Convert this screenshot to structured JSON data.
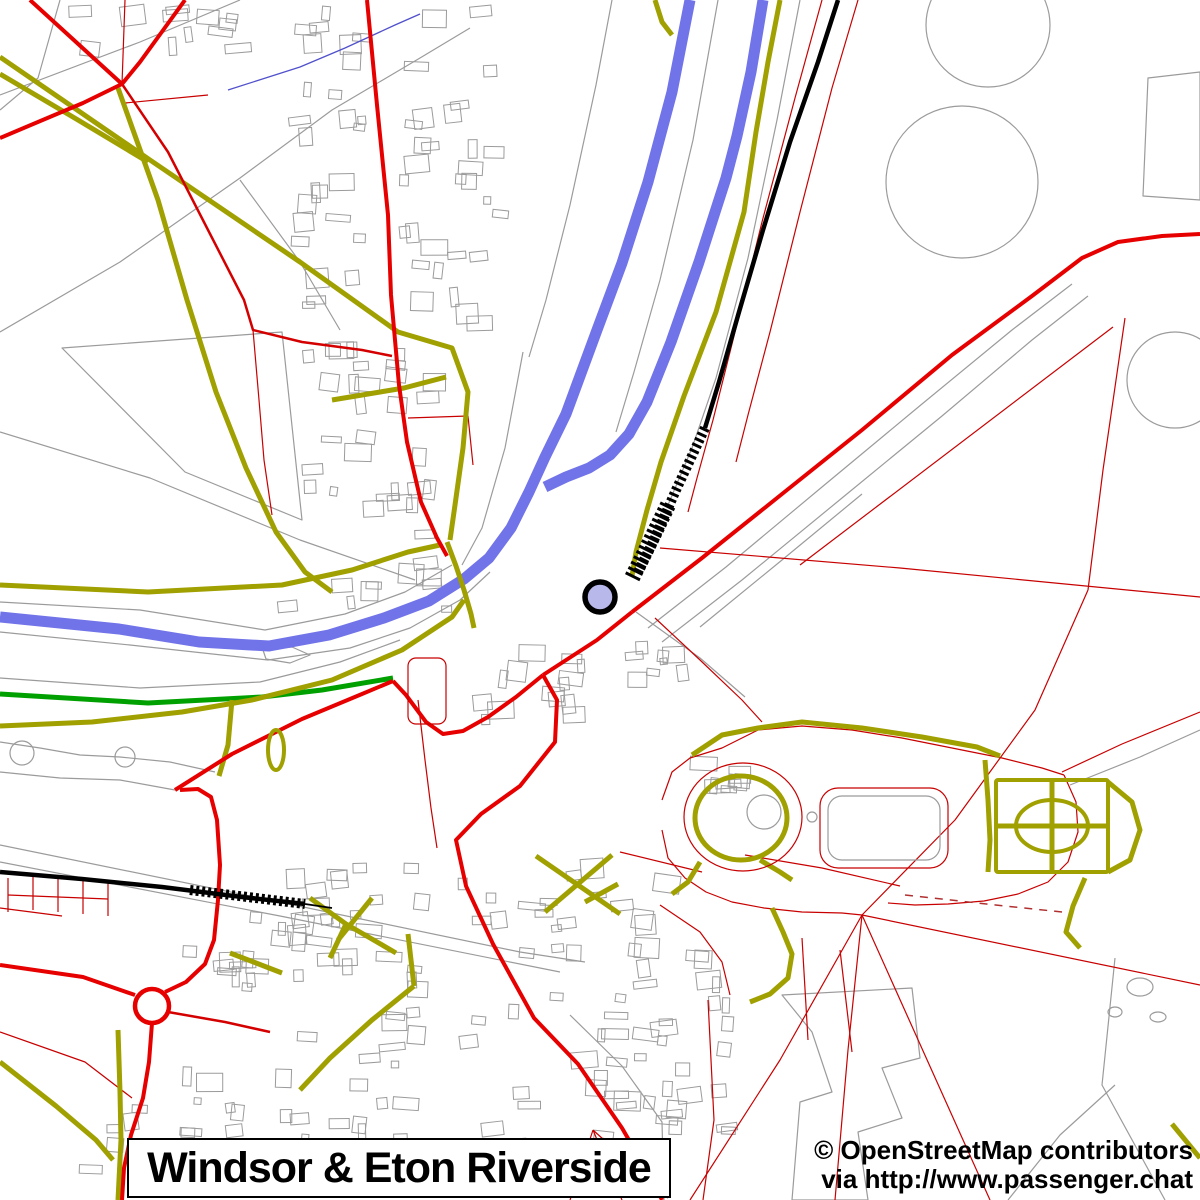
{
  "title_box": {
    "label": "Windsor & Eton Riverside"
  },
  "attribution": {
    "line1": "© OpenStreetMap contributors",
    "line2": "via http://www.passenger.chat"
  },
  "map": {
    "width": 1200,
    "height": 1200,
    "background": "#ffffff",
    "colors": {
      "river": "#7173e8",
      "stream": "#5050cc",
      "road_major": "#e60000",
      "road_mid": "#d40000",
      "road_minor": "#c80000",
      "footpath": "#a0a000",
      "green_route": "#00a000",
      "railway": "#000000",
      "boundary": "#9b9b9b",
      "marker_fill": "#b8b9ea"
    },
    "building_clusters": [
      {
        "x": 288,
        "y": 6,
        "w": 86,
        "h": 330,
        "count": 26,
        "seed": 7
      },
      {
        "x": 398,
        "y": 6,
        "w": 112,
        "h": 330,
        "count": 30,
        "seed": 13
      },
      {
        "x": 300,
        "y": 342,
        "w": 152,
        "h": 212,
        "count": 30,
        "seed": 21
      },
      {
        "x": 262,
        "y": 556,
        "w": 200,
        "h": 60,
        "count": 10,
        "seed": 29
      },
      {
        "x": 60,
        "y": 2,
        "w": 200,
        "h": 55,
        "count": 12,
        "seed": 31
      },
      {
        "x": 255,
        "y": 855,
        "w": 195,
        "h": 290,
        "count": 40,
        "seed": 37
      },
      {
        "x": 452,
        "y": 858,
        "w": 230,
        "h": 320,
        "count": 46,
        "seed": 41
      },
      {
        "x": 600,
        "y": 935,
        "w": 150,
        "h": 200,
        "count": 24,
        "seed": 43
      },
      {
        "x": 180,
        "y": 908,
        "w": 205,
        "h": 85,
        "count": 18,
        "seed": 47
      },
      {
        "x": 470,
        "y": 640,
        "w": 130,
        "h": 90,
        "count": 14,
        "seed": 53
      },
      {
        "x": 620,
        "y": 620,
        "w": 90,
        "h": 70,
        "count": 8,
        "seed": 59
      },
      {
        "x": 690,
        "y": 745,
        "w": 80,
        "h": 60,
        "count": 8,
        "seed": 67
      },
      {
        "x": 60,
        "y": 1060,
        "w": 200,
        "h": 130,
        "count": 16,
        "seed": 71
      }
    ],
    "layers": [
      {
        "name": "boundary-line",
        "stroke": "#9b9b9b",
        "width": 1.2,
        "paths": [
          "M0,95 L140,42 L240,0",
          "M60,0 L38,78 L0,110",
          "M0,332 L120,262 L240,178 L332,110 L420,58 L470,28",
          "M0,432 L150,478 L300,540 L415,580",
          "M62,348 L282,332 L302,520 L185,472 Z",
          "M240,180 L300,262 L340,330",
          "M523,352 L505,448 L482,528 L462,565",
          "M612,0 L596,85 L570,205 L546,300 L529,357",
          "M718,0 L693,140 L660,280 L634,372 L616,432",
          "M800,0 L777,120 L748,258 L716,378 L692,448 L668,505",
          "M648,628 L726,567 L822,487 L922,404 L1012,330 L1072,284",
          "M662,642 L742,580 L842,498 L942,416 L1032,340 L1088,296",
          "M700,627 L782,560 L862,494",
          "M0,602 L140,610 L265,630 L345,614 L405,592 L452,565",
          "M0,632 L130,645 L268,660 L350,648 L410,628 L460,600 L490,572",
          "M263,650 L292,647 L310,655 L290,663 L266,659 Z",
          "M0,845 L260,898 L520,952 L585,962",
          "M0,862 L280,916 L560,972",
          "M782,995 L912,988 L920,1058 L882,1068 L902,1118 L858,1132 L868,1200 L792,1200 L800,1102 L832,1092 L812,1032 Z",
          "M570,1015 L622,1066 L662,1122 L664,1200",
          "M1115,958 L1102,1085 L1165,1200",
          "M1008,1200 L1060,1135 L1115,1085",
          "M1148,78 L1200,72 L1200,200 L1143,196 Z",
          "M1070,785 L1140,757 L1200,730",
          "M636,612 L700,658 L745,697",
          "M0,742 L40,748 L80,755 L120,757 L170,762 L215,772",
          "M0,772 L60,778 L120,780 L175,790",
          "M0,678 L140,688 L260,682 L340,662 L400,640"
        ]
      },
      {
        "name": "minor-road",
        "stroke": "#c80000",
        "width": 1.2,
        "paths": [
          "M125,0 L122,84",
          "M125,103 L208,95",
          "M822,0 L795,98 L762,222 L733,340 L713,420 L697,478 L688,512",
          "M858,0 L832,88 L800,212 L770,332 L748,415 L736,462",
          "M800,565 L1113,327",
          "M1125,318 L1103,470 L1088,590",
          "M660,548 L900,568 L1200,597",
          "M1088,590 L1035,710 L955,820 L862,915",
          "M862,915 L1200,985",
          "M862,915 L990,1200",
          "M862,915 L848,1050 L835,1200",
          "M862,915 L780,1060 L690,1200",
          "M655,618 L700,660 L742,700 L762,722",
          "M662,800 L672,772 L690,758 L722,748 L758,730 L802,726 L852,730 L902,738 L952,748 L1002,758 L1042,768 L1064,775",
          "M662,830 L668,858 L685,878 L706,892 L732,902 L764,908 L802,912 L842,913 L862,915",
          "M1064,775 L1076,802 L1078,832 L1068,862 L1048,882 L1018,894 L984,901 L948,904 L915,905 L888,903",
          "M1062,772 L1122,744 L1200,712",
          "M8,878 L8,912",
          "M33,876 L33,910",
          "M58,878 L58,912",
          "M83,880 L83,914",
          "M108,882 L108,916",
          "M8,895 L108,899",
          "M418,700 L425,760 L431,808 L437,848",
          "M745,855 L822,868 L900,886",
          "M620,852 L702,872",
          "M660,905 L700,932 L722,962 L730,995",
          "M802,938 L808,1040",
          "M840,950 L852,1052",
          "M708,1000 L714,1120 L703,1200",
          "M593,1130 L570,1200",
          "M593,1130 L622,1200",
          "M593,1130 L668,1198",
          "M0,1032 L85,1062 L132,1098",
          "M408,418 L468,416 L473,465",
          "M0,908 L62,916",
          "M253,330 L259,400 L264,460 L272,515"
        ]
      },
      {
        "name": "fence-dash",
        "stroke": "#b03030",
        "width": 1.5,
        "dash": "8 7",
        "paths": [
          "M905,895 L1005,906 L1062,912"
        ]
      },
      {
        "name": "river",
        "stroke": "#7173e8",
        "width": 11,
        "paths": [
          "M690,0 L672,92 L648,182 L622,263 L597,330 L566,414 L545,457 L529,492 L511,528 L489,558 L464,579 L429,601 L384,618 L329,635 L269,646 L199,642 L119,629 L0,617",
          "M763,0 L751,72 L737,136 L726,178 L699,262 L671,342 L647,402 L629,434 L610,455 L589,468 L566,477 L545,487"
        ]
      },
      {
        "name": "stream",
        "stroke": "#5050cc",
        "width": 1.3,
        "paths": [
          "M228,90 L300,67 L345,48 L395,25 L420,14"
        ]
      },
      {
        "name": "green-route",
        "stroke": "#00a000",
        "width": 5,
        "paths": [
          "M0,694 L148,703 L262,697 L322,690 L393,678"
        ]
      },
      {
        "name": "footpath",
        "stroke": "#a0a000",
        "width": 5,
        "paths": [
          "M0,57 L150,160 L300,262 L398,332 L452,348 L468,392 L463,448 L455,505 L450,540",
          "M0,74 L78,120 L148,162",
          "M118,88 L158,200 L187,300 L216,392 L246,468 L276,532 L305,572 L332,592",
          "M332,400 L404,388 L446,377",
          "M0,585 L148,592 L282,585 L352,570 L408,552 L440,545",
          "M0,726 L92,722 L182,712 L252,700 L332,680 L402,650 L452,617 L464,600",
          "M447,542 L456,566 L464,590 L471,614 L474,628",
          "M780,0 L768,62 L756,132 L744,212 L716,312 L684,396 L661,462 L647,510 L636,552 L632,576",
          "M232,700 L228,745 L219,776",
          "M310,898 L346,924 L396,953",
          "M372,898 L338,940",
          "M408,934 L414,986",
          "M346,924 L330,958",
          "M230,953 L282,973",
          "M536,856 L620,914",
          "M612,855 L545,912",
          "M585,902 L618,884",
          "M414,986 L372,1020 L330,1058 L300,1090",
          "M118,1030 L120,1092 L121,1140 L118,1200",
          "M0,1062 L56,1106 L96,1140 L113,1160",
          "M692,755 L722,735 L758,728 L802,722 L862,728 L922,737 L977,747 L1000,756",
          "M996,826 L1108,826",
          "M1052,780 L1052,872",
          "M1108,782 L1132,802 L1140,830 L1130,860 L1108,872",
          "M985,760 L988,800 L990,840 L988,872",
          "M1085,878 L1073,906 L1066,932 L1080,948",
          "M772,908 L783,932 L792,954 L788,978 L770,994 L750,1002",
          "M700,862 L688,882 L672,894",
          "M760,860 L780,872 L792,880",
          "M1172,1124 L1200,1158",
          "M655,0 L662,22 L672,35"
        ]
      },
      {
        "name": "mid-road",
        "stroke": "#d40000",
        "width": 2.5,
        "paths": [
          "M122,84 L168,152 L207,228 L244,300 L253,330 L302,342 L362,350 L392,356",
          "M168,1012 L225,1022 L270,1032"
        ]
      },
      {
        "name": "major-road",
        "stroke": "#e60000",
        "width": 4,
        "paths": [
          "M367,0 L377,105 L388,215 L391,295 L399,385 L407,442 L421,502 L437,538 L447,556",
          "M185,0 L140,62 L122,84 L83,103 L0,138",
          "M30,0 L76,42 L122,84",
          "M632,612 L702,558 L782,494 L862,430 L952,355 L1032,296 L1082,258 L1118,242 L1162,236 L1200,234",
          "M632,612 L597,640 L543,675",
          "M175,790 L232,754 L302,719 L362,694 L393,681",
          "M393,681 L406,695 L426,722 L443,734 L463,731 L488,717 L516,697 L543,675",
          "M543,675 L557,700 L555,742 L520,786 L481,814 L456,840 L466,886 L493,944 L534,1018 L578,1064 L622,1128 L655,1185 L662,1200",
          "M0,965 L83,977 L135,995",
          "M152,1023 L149,1062 L143,1098 L131,1135 L124,1168 L122,1200",
          "M165,992 L186,982 L205,964 L214,940 L218,900 L220,865 L217,820 L211,797 L198,789 L180,790"
        ]
      },
      {
        "name": "railway",
        "stroke": "#000000",
        "width": 4.5,
        "paths": [
          "M838,0 L818,62 L790,142 L763,230 L739,312 L719,382 L705,428",
          "M0,872 L82,879 L162,887 L242,897 L305,904"
        ]
      },
      {
        "name": "railway-hatch",
        "stroke": "#000000",
        "width": 10,
        "dash": "3 3",
        "paths": [
          "M705,428 L676,490 L654,540 L638,572",
          "M190,890 L305,904"
        ]
      },
      {
        "name": "railway-hatch",
        "stroke": "#000000",
        "width": 16,
        "dash": "3 3",
        "paths": [
          "M668,505 L645,552 L632,578"
        ]
      },
      {
        "name": "railway-tail",
        "stroke": "#000000",
        "width": 1.8,
        "paths": [
          "M305,904 L332,908"
        ]
      }
    ],
    "shapes": [
      {
        "kind": "circle",
        "name": "tree-ring",
        "cx": 988,
        "cy": 25,
        "r": 62,
        "stroke": "#9b9b9b",
        "width": 1.2
      },
      {
        "kind": "circle",
        "name": "tree-ring",
        "cx": 962,
        "cy": 182,
        "r": 76,
        "stroke": "#9b9b9b",
        "width": 1.2
      },
      {
        "kind": "circle",
        "name": "tree-ring",
        "cx": 1175,
        "cy": 380,
        "r": 48,
        "stroke": "#9b9b9b",
        "width": 1.2
      },
      {
        "kind": "circle",
        "name": "round-tower",
        "cx": 764,
        "cy": 812,
        "r": 17,
        "stroke": "#9b9b9b",
        "width": 1.2
      },
      {
        "kind": "circle",
        "name": "well",
        "cx": 812,
        "cy": 817,
        "r": 5,
        "stroke": "#9b9b9b",
        "width": 1.2
      },
      {
        "kind": "circle",
        "name": "fountain",
        "cx": 22,
        "cy": 753,
        "r": 12,
        "stroke": "#9b9b9b",
        "width": 1.2
      },
      {
        "kind": "circle",
        "name": "fountain",
        "cx": 125,
        "cy": 757,
        "r": 10,
        "stroke": "#9b9b9b",
        "width": 1.2
      },
      {
        "kind": "ellipse",
        "name": "pond",
        "cx": 1140,
        "cy": 987,
        "rx": 13,
        "ry": 9,
        "stroke": "#9b9b9b",
        "width": 1.2
      },
      {
        "kind": "ellipse",
        "name": "pond",
        "cx": 1115,
        "cy": 1012,
        "rx": 7,
        "ry": 5,
        "stroke": "#9b9b9b",
        "width": 1.2
      },
      {
        "kind": "ellipse",
        "name": "pond",
        "cx": 1158,
        "cy": 1017,
        "rx": 8,
        "ry": 5,
        "stroke": "#9b9b9b",
        "width": 1.2
      },
      {
        "kind": "ellipse",
        "name": "moat-garden-path",
        "cx": 741,
        "cy": 818,
        "rx": 46,
        "ry": 42,
        "stroke": "#a0a000",
        "width": 5
      },
      {
        "kind": "ellipse",
        "name": "castle-moat-wall",
        "cx": 743,
        "cy": 817,
        "rx": 59,
        "ry": 54,
        "stroke": "#c80000",
        "width": 1.2
      },
      {
        "kind": "rect",
        "name": "quadrangle",
        "x": 828,
        "y": 796,
        "w": 112,
        "h": 64,
        "rx": 14,
        "stroke": "#9b9b9b",
        "width": 1.2
      },
      {
        "kind": "rect",
        "name": "quadrangle-wall",
        "x": 820,
        "y": 788,
        "w": 128,
        "h": 80,
        "rx": 18,
        "stroke": "#c80000",
        "width": 1.2
      },
      {
        "kind": "rect",
        "name": "carpark-outline",
        "x": 408,
        "y": 658,
        "w": 38,
        "h": 66,
        "rx": 8,
        "stroke": "#c80000",
        "width": 1.2
      },
      {
        "kind": "ellipse",
        "name": "bandstand-path",
        "cx": 276,
        "cy": 750,
        "rx": 8,
        "ry": 20,
        "stroke": "#a0a000",
        "width": 4
      },
      {
        "kind": "ellipse",
        "name": "garden-ellipse-path",
        "cx": 1052,
        "cy": 826,
        "rx": 36,
        "ry": 26,
        "stroke": "#a0a000",
        "width": 4
      },
      {
        "kind": "rect",
        "name": "east-terrace-garden",
        "x": 996,
        "y": 780,
        "w": 112,
        "h": 92,
        "rx": 2,
        "stroke": "#a0a000",
        "width": 4
      },
      {
        "kind": "circle",
        "name": "roundabout",
        "cx": 152,
        "cy": 1006,
        "r": 17,
        "stroke": "#e60000",
        "width": 4.5
      }
    ],
    "markers": [
      {
        "kind": "circle",
        "name": "station-marker",
        "cx": 600,
        "cy": 597,
        "r": 15,
        "fill": "#b8b9ea",
        "stroke": "#000000",
        "width": 5.5
      }
    ]
  }
}
